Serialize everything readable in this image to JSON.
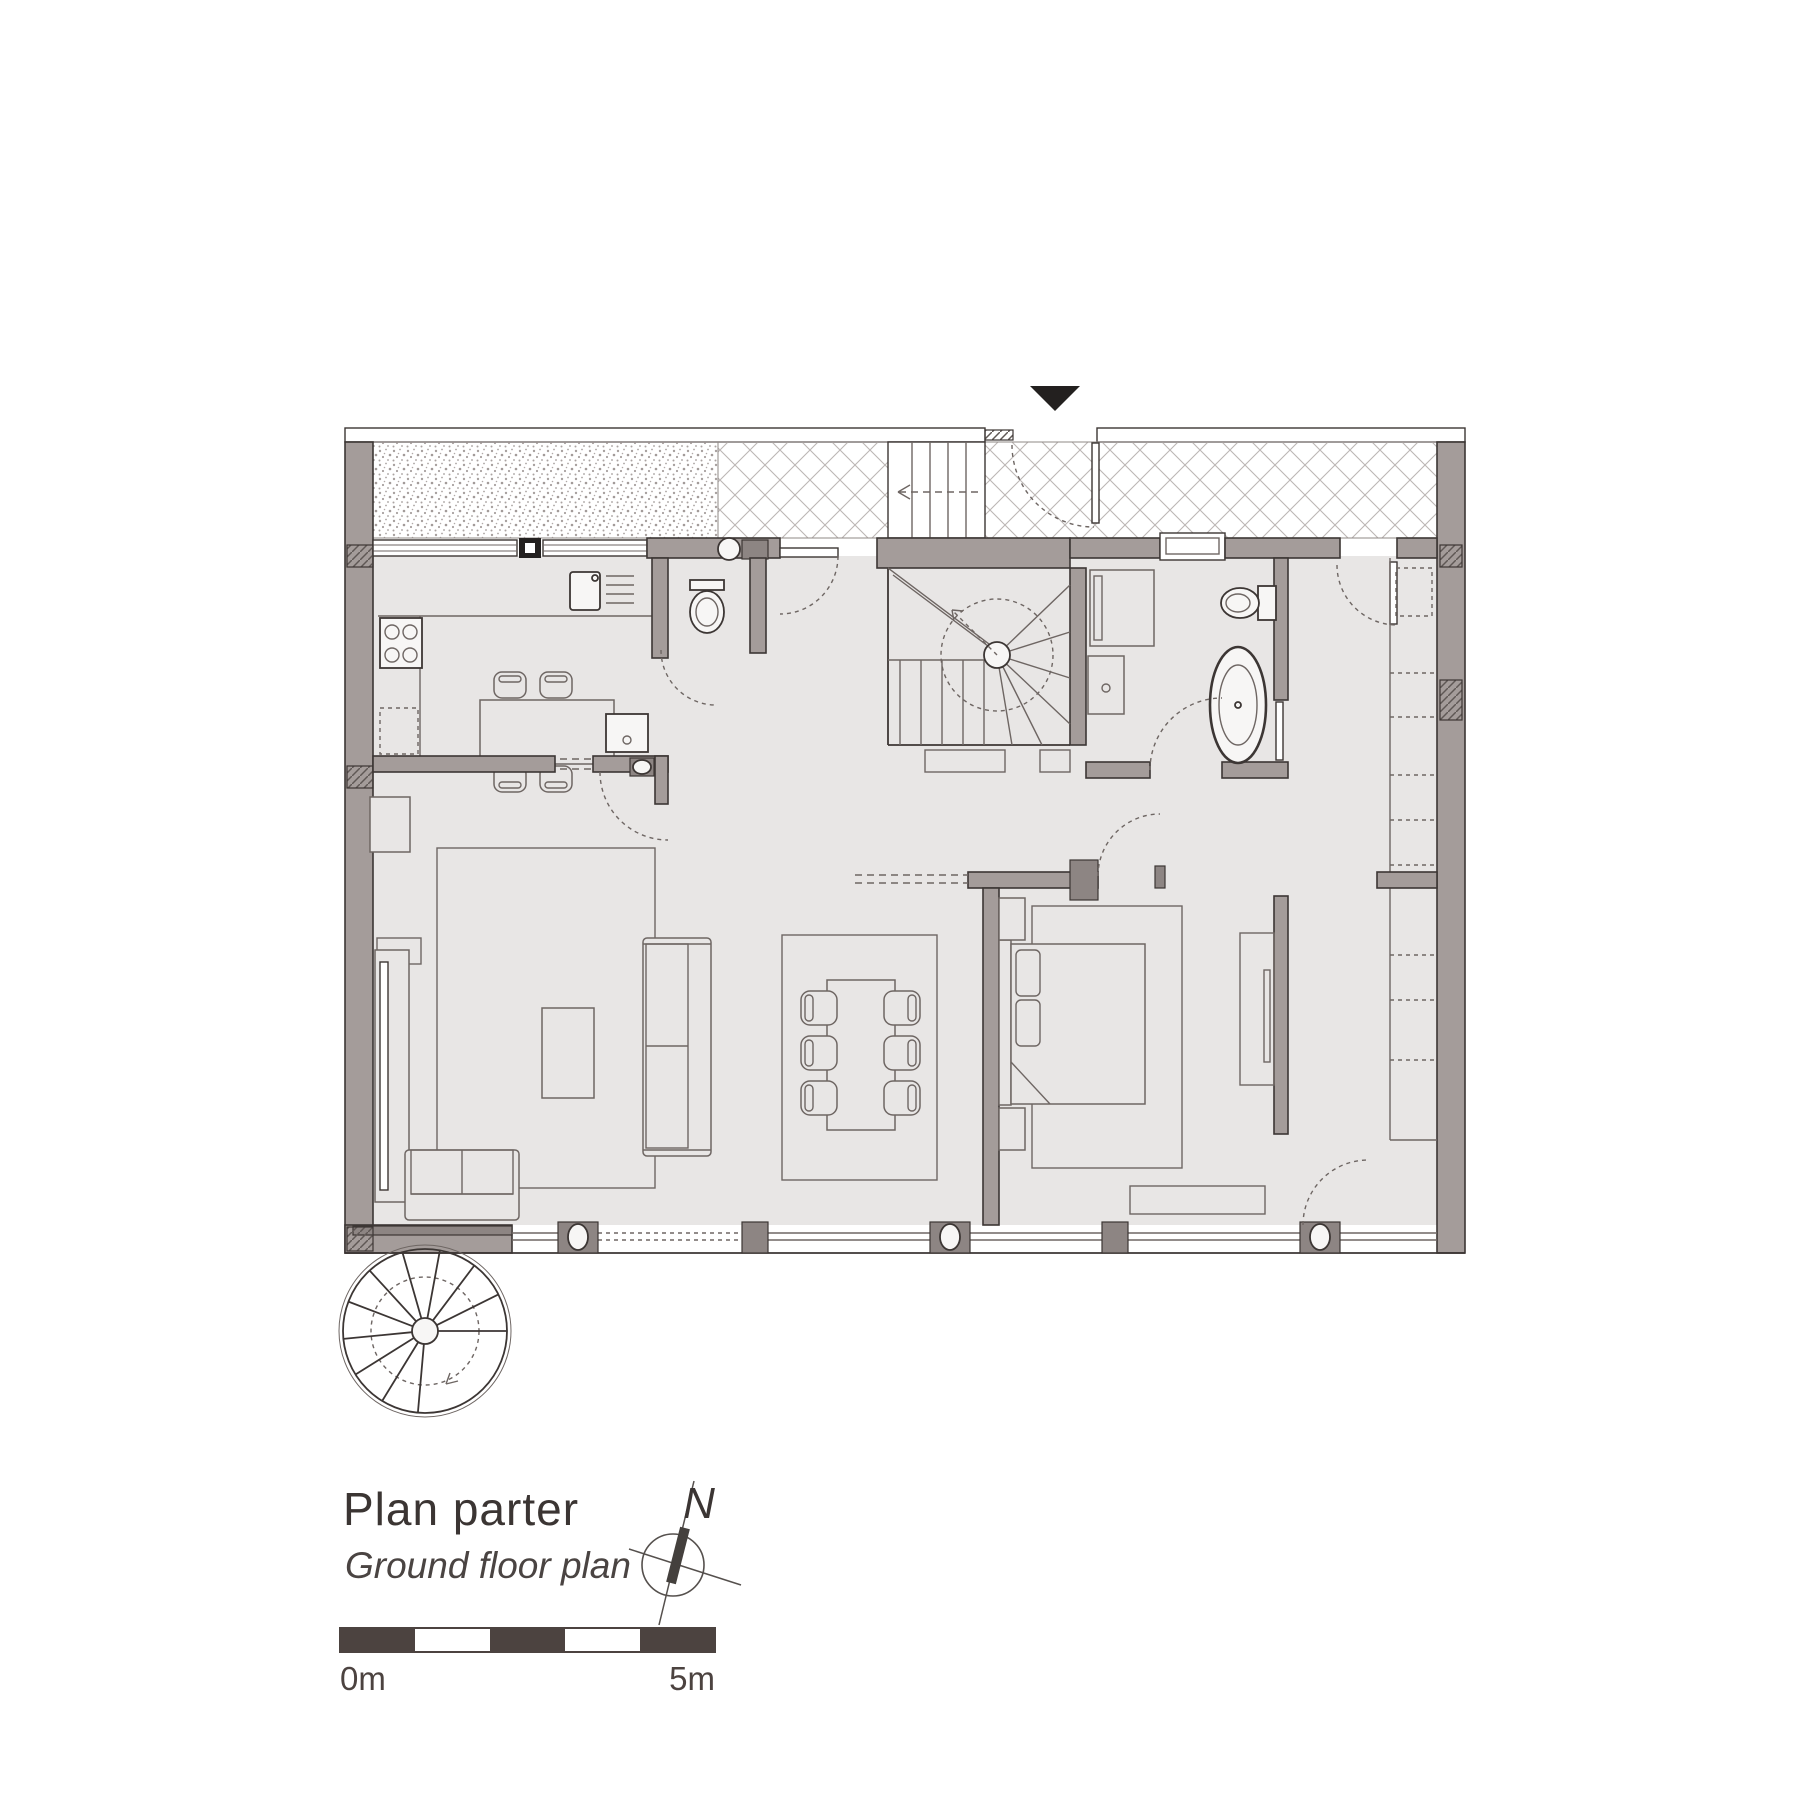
{
  "title": {
    "primary": "Plan parter",
    "secondary": "Ground floor plan"
  },
  "compass": {
    "north_label": "N"
  },
  "scale_bar": {
    "start_label": "0m",
    "end_label": "5m",
    "segments": 5
  },
  "entrance_marker": {
    "shape": "filled-triangle-down"
  },
  "colors": {
    "background": "#ffffff",
    "wall_fill": "#a49c9a",
    "wall_dark": "#8d8583",
    "floor_fill": "#e8e6e5",
    "ink": "#3c3634",
    "line": "#6e6663",
    "accent": "#4c4340",
    "hatch": "#bab4b2",
    "fixture": "#f7f6f5"
  },
  "depicted_rooms": [
    "kitchen",
    "wc",
    "entry-hall",
    "winder-staircase",
    "bathroom",
    "dressing-area",
    "living-room",
    "dining-area",
    "bedroom",
    "terrace-strip"
  ],
  "depicted_elements": [
    "entrance-triangle",
    "exterior-steps",
    "spiral-staircase",
    "kitchen-table",
    "dining-table-six-chairs",
    "sofas",
    "coffee-table",
    "double-bed",
    "freestanding-bathtub",
    "toilets",
    "washbasins",
    "wardrobe-column",
    "glazed-facade-with-columns",
    "door-swing-arcs",
    "north-compass",
    "graphic-scale"
  ]
}
